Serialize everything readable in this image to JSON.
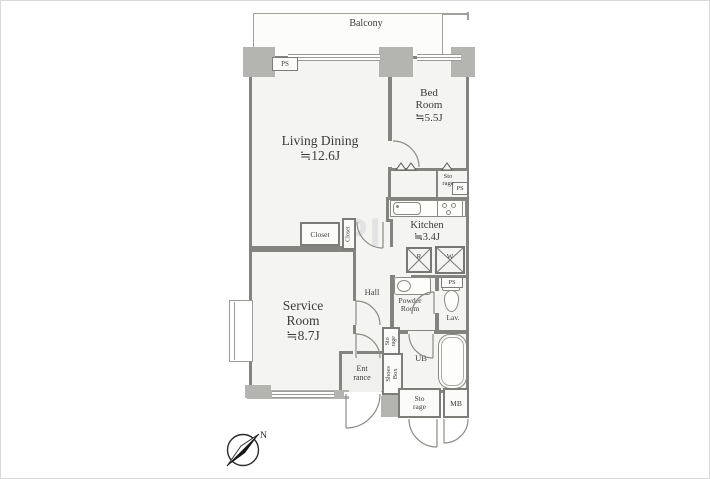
{
  "plan": {
    "balcony": {
      "label": "Balcony"
    },
    "living_dining": {
      "name": "Living Dining",
      "size": "≒12.6J"
    },
    "bed_room": {
      "l1": "Bed",
      "l2": "Room",
      "size": "≒5.5J"
    },
    "kitchen": {
      "name": "Kitchen",
      "size": "≒3.4J"
    },
    "service_room": {
      "l1": "Service",
      "l2": "Room",
      "size": "≒8.7J"
    },
    "hall": {
      "label": "Hall"
    },
    "powder_room": {
      "l1": "Powder",
      "l2": "Room"
    },
    "lavatory": {
      "label": "Lav."
    },
    "unit_bath": {
      "label": "UB"
    },
    "entrance": {
      "l1": "Ent",
      "l2": "rance"
    },
    "closet_a": {
      "label": "Closet"
    },
    "closet_b": {
      "label": "Closet"
    },
    "storage_bedroom": {
      "l1": "Sto",
      "l2": "rage"
    },
    "storage_hall": {
      "l1": "Sto",
      "l2": "rage"
    },
    "storage_entrance": {
      "l1": "Sto",
      "l2": "rage"
    },
    "shoes_box": {
      "l1": "Shoes",
      "l2": "Box"
    },
    "meter_box": {
      "label": "MB"
    },
    "pipe_space": {
      "label": "PS"
    },
    "appliances": {
      "refrigerator": "R",
      "washer": "W"
    },
    "compass": {
      "north": "N"
    },
    "watermark": {
      "text": "PI"
    }
  },
  "colors": {
    "wall": "#83837f",
    "floor": "#f4f4f2",
    "pillar": "#b4b4b0",
    "text": "#3b3b3b"
  }
}
